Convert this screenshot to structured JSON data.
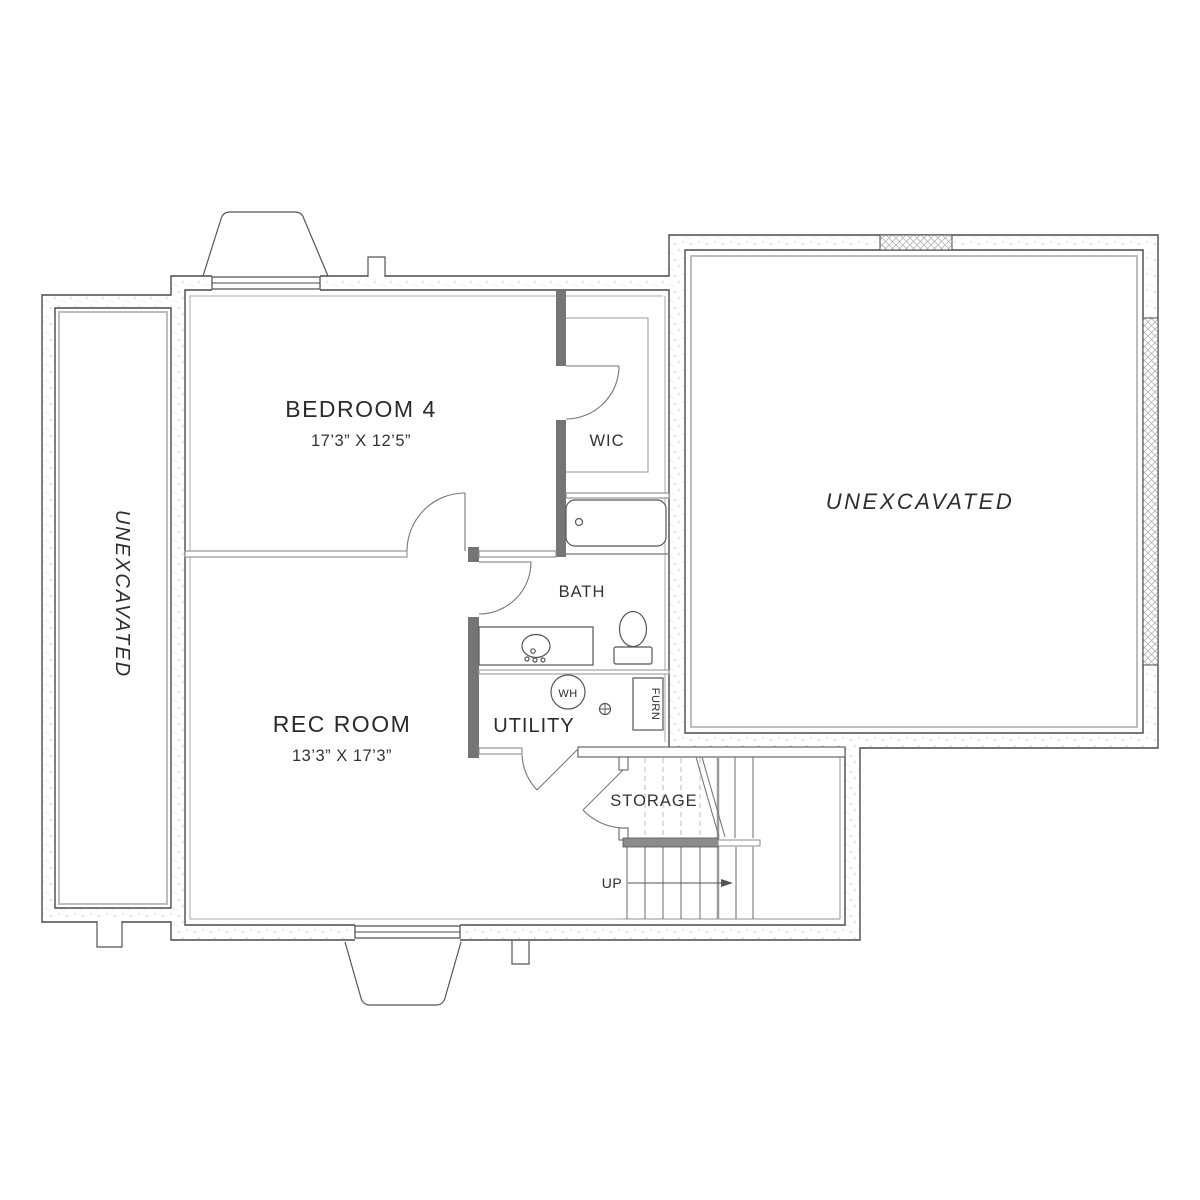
{
  "plan": {
    "type": "basement-floor-plan",
    "colors": {
      "wall_outline": "#4a4a4a",
      "dark_partition": "#757575",
      "thin_wall": "#8a8a8a",
      "gray_inset": "#bdbdbd",
      "stair_bar": "#8c8c8c",
      "text": "#2b2b2b",
      "background": "#ffffff"
    },
    "rooms": {
      "bedroom4": {
        "label": "BEDROOM 4",
        "dimensions": "17’3” X 12’5”"
      },
      "wic": {
        "label": "WIC"
      },
      "bath": {
        "label": "BATH"
      },
      "rec_room": {
        "label": "REC ROOM",
        "dimensions": "13’3” X 17’3”"
      },
      "utility": {
        "label": "UTILITY"
      },
      "storage": {
        "label": "STORAGE"
      },
      "unexcavated_left": {
        "label": "UNEXCAVATED"
      },
      "unexcavated_right": {
        "label": "UNEXCAVATED"
      }
    },
    "fixtures": {
      "water_heater": {
        "label": "WH"
      },
      "furnace": {
        "label": "FURN"
      }
    },
    "stairs": {
      "direction_label": "UP"
    }
  }
}
